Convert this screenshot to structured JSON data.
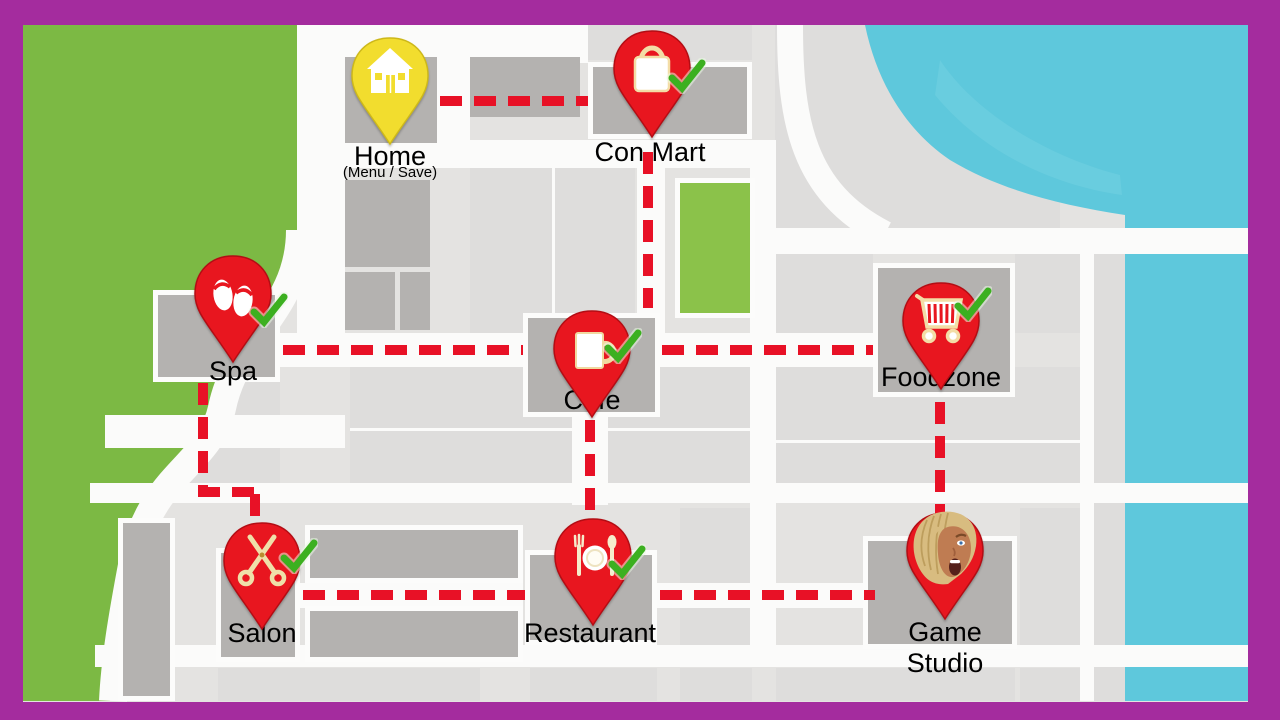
{
  "screen": "town-map",
  "locations": [
    {
      "id": "home",
      "label": "Home",
      "sublabel": "(Menu / Save)",
      "icon": "house-icon",
      "pin_color": "#f2dd2e",
      "checked": false
    },
    {
      "id": "con-mart",
      "label": "Con Mart",
      "icon": "shopping-bag-icon",
      "pin_color": "#e8161f",
      "checked": true
    },
    {
      "id": "spa",
      "label": "Spa",
      "icon": "flip-flops-icon",
      "pin_color": "#e8161f",
      "checked": true
    },
    {
      "id": "cafe",
      "label": "Cafe",
      "icon": "mug-icon",
      "pin_color": "#e8161f",
      "checked": true
    },
    {
      "id": "foodzone",
      "label": "Foodzone",
      "icon": "shopping-cart-icon",
      "pin_color": "#e8161f",
      "checked": true
    },
    {
      "id": "salon",
      "label": "Salon",
      "icon": "scissors-icon",
      "pin_color": "#e8161f",
      "checked": true
    },
    {
      "id": "restaurant",
      "label": "Restaurant",
      "icon": "cutlery-icon",
      "pin_color": "#e8161f",
      "checked": true
    },
    {
      "id": "game-studio",
      "label": "Game Studio",
      "line1": "Game",
      "line2": "Studio",
      "icon": "character-face-icon",
      "pin_color": "#e8161f",
      "checked": false
    }
  ],
  "routes": [
    [
      "Home",
      "Con Mart"
    ],
    [
      "Con Mart",
      "Cafe"
    ],
    [
      "Spa",
      "Cafe"
    ],
    [
      "Cafe",
      "Foodzone"
    ],
    [
      "Cafe",
      "Restaurant"
    ],
    [
      "Spa",
      "Salon"
    ],
    [
      "Salon",
      "Restaurant"
    ],
    [
      "Restaurant",
      "Game Studio"
    ],
    [
      "Foodzone",
      "Game Studio"
    ]
  ],
  "colors": {
    "frame": "#a42c9e",
    "map_background": "#e4e3e1",
    "road": "#fbfbfa",
    "building": "#b4b2b0",
    "block_light": "#dedddc",
    "grass": "#7cb944",
    "park": "#8bc24a",
    "water": "#5ec8dc",
    "route_dash": "#e81126",
    "pin_red": "#e8161f",
    "pin_yellow": "#f2dd2e",
    "check_green": "#3cb020",
    "label_text": "#000000"
  }
}
